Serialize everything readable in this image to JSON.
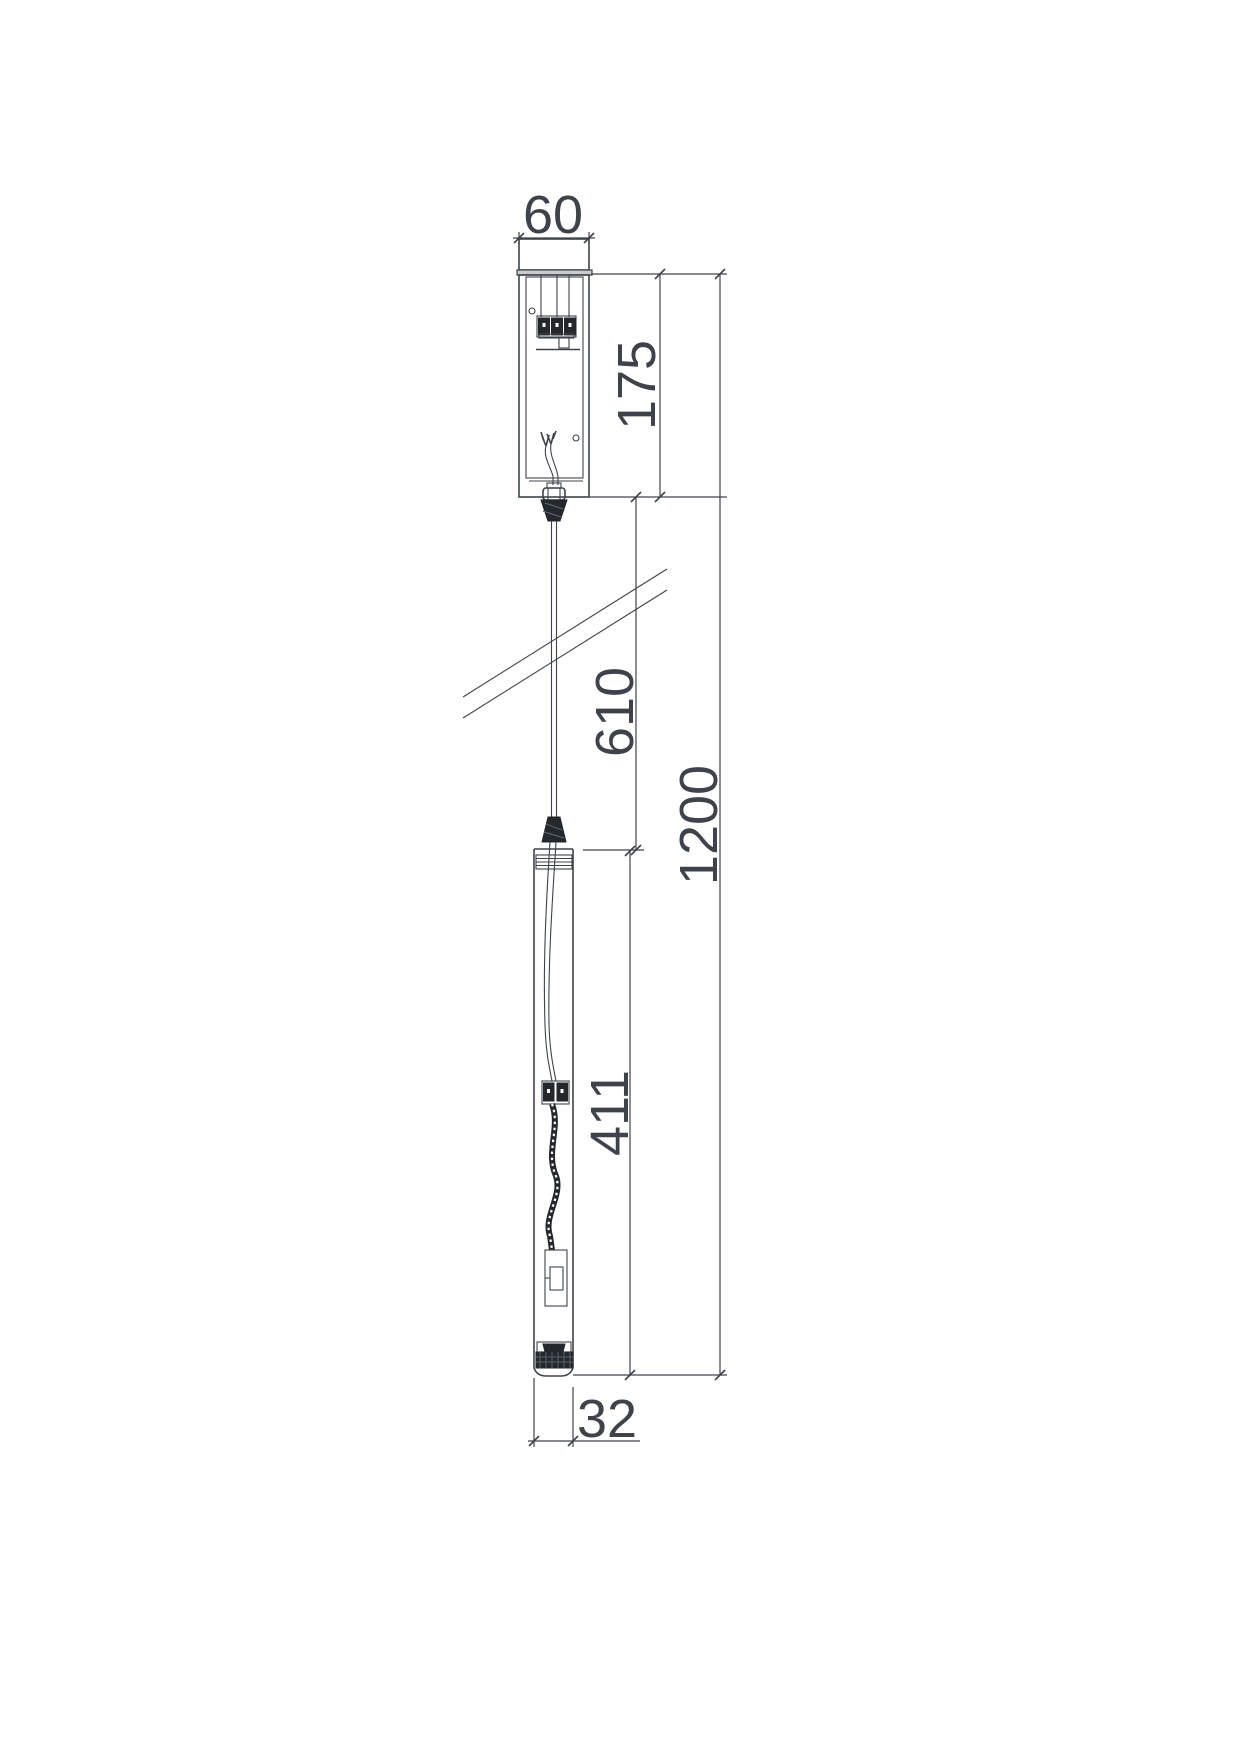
{
  "drawing": {
    "kind": "pendant-luminaire-dimension-drawing",
    "dimensions": {
      "canopy_width": "60",
      "canopy_height": "175",
      "suspension_length": "610",
      "fixture_body_length": "411",
      "overall_length": "1200",
      "tube_width": "32"
    },
    "colors": {
      "line": "#3e434b",
      "dark_fill": "#24272c",
      "plate_fill": "#c9cbcd",
      "background": "#ffffff"
    }
  }
}
